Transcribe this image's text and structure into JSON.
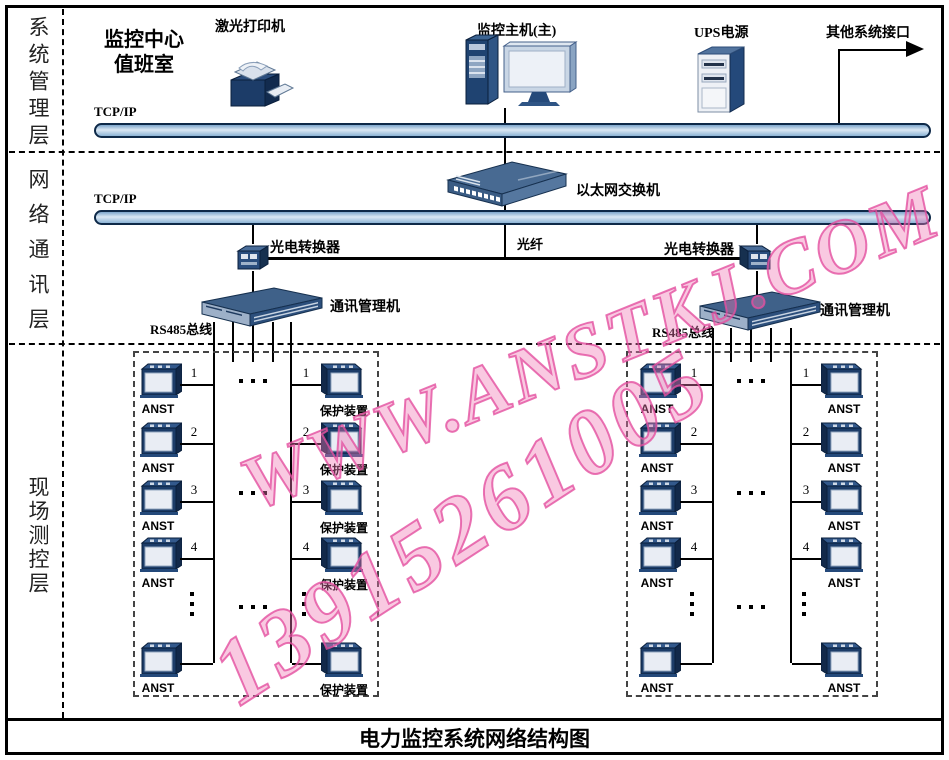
{
  "title_bar": {
    "title": "电力监控系统网络结构图"
  },
  "sidebar": {
    "layers": [
      {
        "label": "系统管理层"
      },
      {
        "label": "网络通讯层"
      },
      {
        "label": "现场测控层"
      }
    ]
  },
  "management": {
    "room_label_line1": "监控中心",
    "room_label_line2": "值班室",
    "printer_label": "激光打印机",
    "host_label": "监控主机(主)",
    "ups_label": "UPS电源",
    "other_interface_label": "其他系统接口",
    "bus_label": "TCP/IP"
  },
  "network": {
    "bus_label": "TCP/IP",
    "switch_label": "以太网交换机",
    "fiber_label": "光纤",
    "converter_left_label": "光电转换器",
    "converter_right_label": "光电转换器",
    "comm_left_label": "通讯管理机",
    "comm_right_label": "通讯管理机",
    "rs485_left_label": "RS485总线",
    "rs485_right_label": "RS485总线"
  },
  "field": {
    "row_numbers": [
      "1",
      "2",
      "3",
      "4"
    ],
    "groups": [
      {
        "columns": [
          {
            "device_label": "ANST"
          },
          {
            "device_label": "保护装置"
          }
        ]
      },
      {
        "columns": [
          {
            "device_label": "ANST"
          },
          {
            "device_label": "ANST"
          }
        ]
      }
    ]
  },
  "watermark": {
    "line1": "WWW.ANSTKJ.COM",
    "line2": "13915261005",
    "color": "#e560a2"
  },
  "colors": {
    "device_navy": "#1c3c68",
    "panel_light": "#e9edf4",
    "bus_border": "#0e2948",
    "bus_fill": "#dbe8f4",
    "watermark_pink": "#e560a2"
  }
}
